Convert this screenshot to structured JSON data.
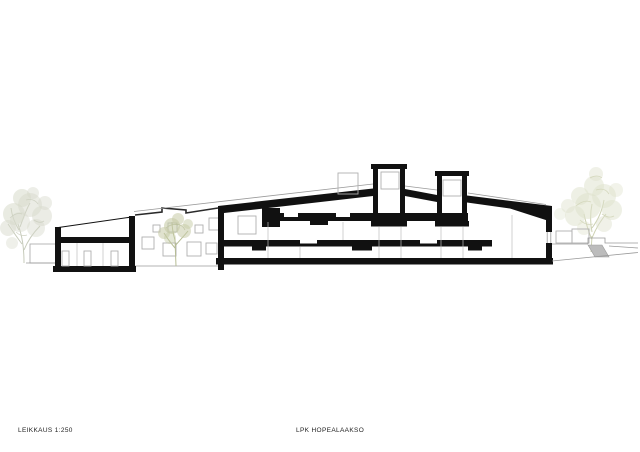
{
  "title_block": {
    "drawing_label": "LEIKKAUS 1:250",
    "project_label": "LPK HOPEALAAKSO"
  },
  "drawing": {
    "type": "architectural-section-elevation",
    "scale": "1:250",
    "elements": {
      "left_wing": "single-storey cut section with three door openings",
      "main_section": "two-storey cut section with three black slab bands",
      "skylight_towers": 2,
      "background_facade_windows": 8,
      "trees": 3,
      "site_stair_ramp": "right side"
    }
  },
  "colors": {
    "paper": "#ffffff",
    "ink": "#111111",
    "thin_line": "#9a9a9a",
    "light_line": "#b0b0b0",
    "tree_left": "#d7dacb",
    "tree_mid": "#c6cba6",
    "tree_right": "#dee1cb",
    "ramp_fill": "#bcbcbc"
  }
}
